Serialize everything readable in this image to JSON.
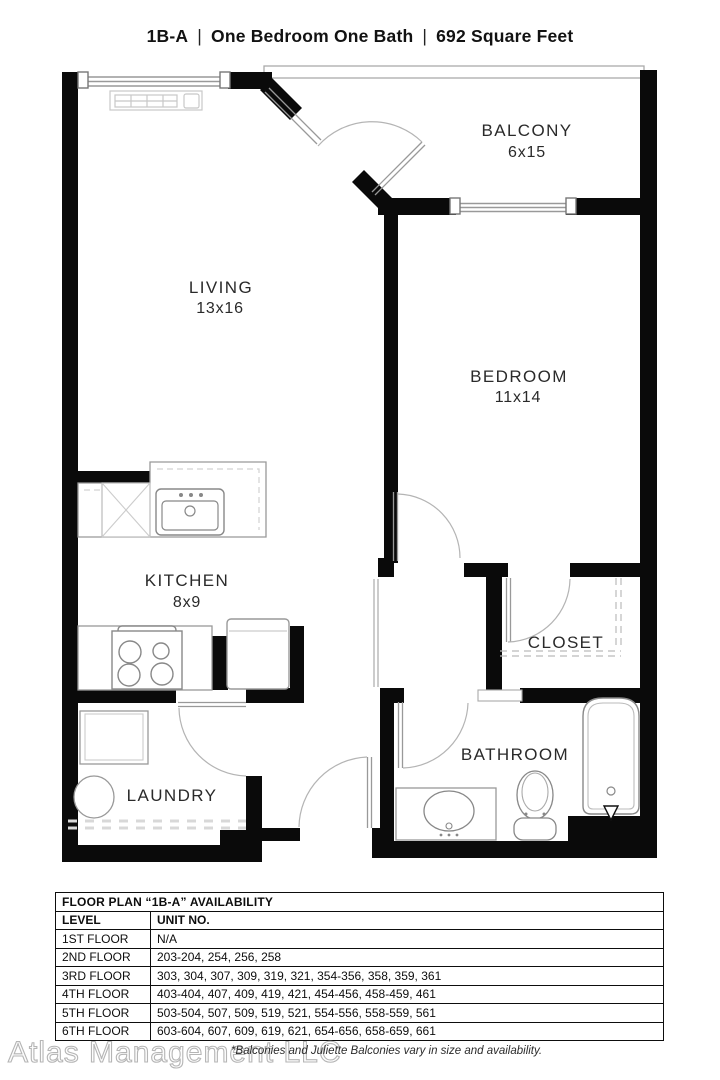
{
  "header": {
    "plan_code": "1B-A",
    "separator": "|",
    "bed_bath": "One Bedroom One Bath",
    "area": "692 Square Feet"
  },
  "rooms": {
    "balcony": {
      "label": "BALCONY",
      "dims": "6x15"
    },
    "living": {
      "label": "LIVING",
      "dims": "13x16"
    },
    "bedroom": {
      "label": "BEDROOM",
      "dims": "11x14"
    },
    "kitchen": {
      "label": "KITCHEN",
      "dims": "8x9"
    },
    "closet": {
      "label": "CLOSET"
    },
    "bathroom": {
      "label": "BATHROOM"
    },
    "laundry": {
      "label": "LAUNDRY"
    }
  },
  "availability_table": {
    "title": "FLOOR PLAN “1B-A” AVAILABILITY",
    "columns": [
      "LEVEL",
      "UNIT NO."
    ],
    "rows": [
      {
        "level": "1ST FLOOR",
        "units": "N/A"
      },
      {
        "level": "2ND FLOOR",
        "units": "203-204, 254, 256, 258"
      },
      {
        "level": "3RD FLOOR",
        "units": "303, 304, 307, 309, 319, 321, 354-356, 358, 359, 361"
      },
      {
        "level": "4TH FLOOR",
        "units": "403-404, 407, 409, 419, 421, 454-456, 458-459, 461"
      },
      {
        "level": "5TH FLOOR",
        "units": "503-504, 507, 509, 519, 521, 554-556, 558-559, 561"
      },
      {
        "level": "6TH FLOOR",
        "units": "603-604, 607, 609, 619, 621, 654-656, 658-659, 661"
      }
    ]
  },
  "footer": {
    "watermark": "Atlas Management LLC",
    "note": "*Balconies and Juliette Balconies vary in size and availability."
  },
  "colors": {
    "wall": "#0a0a0a",
    "thin_line": "#9a9a9a",
    "fixture": "#8c8c8c",
    "text": "#2a2a2a"
  }
}
